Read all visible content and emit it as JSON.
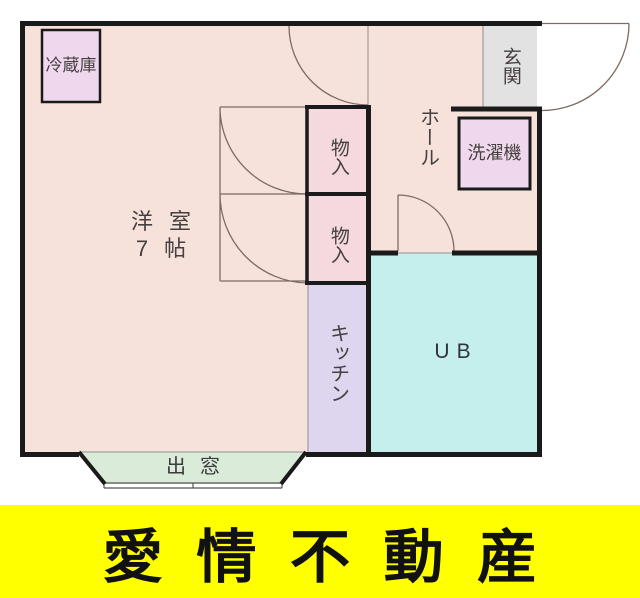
{
  "floorplan": {
    "western_room": {
      "name": "洋室",
      "size": "7帖"
    },
    "hall": {
      "label": "ホール"
    },
    "entrance": {
      "label": "玄関"
    },
    "kitchen": {
      "label": "キッチン"
    },
    "unit_bath": {
      "label": "UB"
    },
    "closet_upper": {
      "label": "物入"
    },
    "closet_lower": {
      "label": "物入"
    },
    "bay_window": {
      "label": "出窓"
    },
    "refrigerator": {
      "label": "冷蔵庫"
    },
    "washing_machine": {
      "label": "洗濯機"
    },
    "colors": {
      "floor": "#f6e2da",
      "closet": "#f5d9de",
      "kitchen": "#ded5ee",
      "unit_bath": "#c5efed",
      "entrance": "#e2e2e2",
      "bay_window": "#daebda",
      "appliance": "#efd7ee",
      "wall": "#1a1a1a"
    }
  },
  "banner": {
    "text": "愛情不動産",
    "background": "#ffff00",
    "text_color": "#111111"
  }
}
